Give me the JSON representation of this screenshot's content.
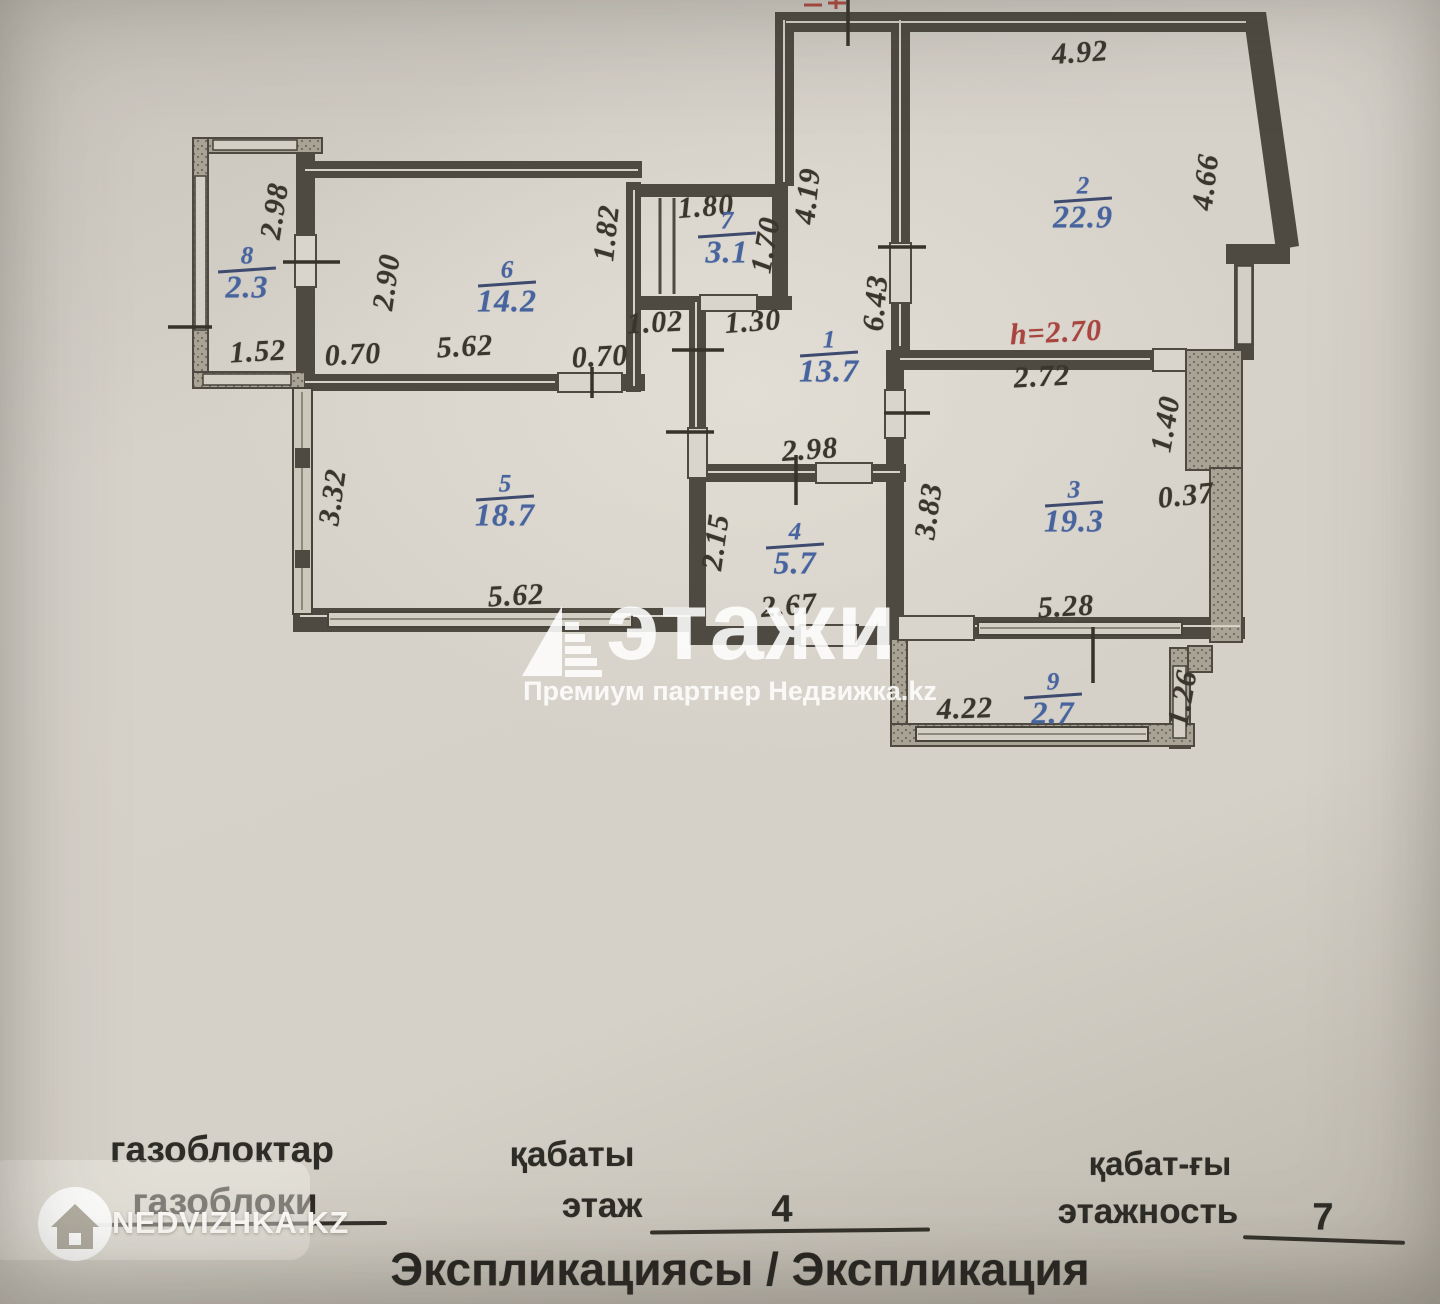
{
  "plan": {
    "rooms": [
      {
        "num": "8",
        "area": "2.3",
        "x": 247,
        "y": 273
      },
      {
        "num": "6",
        "area": "14.2",
        "x": 507,
        "y": 287
      },
      {
        "num": "7",
        "area": "3.1",
        "x": 727,
        "y": 238
      },
      {
        "num": "1",
        "area": "13.7",
        "x": 829,
        "y": 357
      },
      {
        "num": "2",
        "area": "22.9",
        "x": 1083,
        "y": 203
      },
      {
        "num": "5",
        "area": "18.7",
        "x": 505,
        "y": 501
      },
      {
        "num": "4",
        "area": "5.7",
        "x": 795,
        "y": 549
      },
      {
        "num": "3",
        "area": "19.3",
        "x": 1074,
        "y": 507
      },
      {
        "num": "9",
        "area": "2.7",
        "x": 1053,
        "y": 699
      }
    ],
    "dimensions": [
      {
        "t": "4.92",
        "x": 1080,
        "y": 53,
        "r": -4
      },
      {
        "t": "4.66",
        "x": 1206,
        "y": 182,
        "r": -83
      },
      {
        "t": "4.19",
        "x": 808,
        "y": 196,
        "r": -84
      },
      {
        "t": "6.43",
        "x": 876,
        "y": 303,
        "r": -85
      },
      {
        "t": "1.82",
        "x": 607,
        "y": 233,
        "r": -84
      },
      {
        "t": "1.80",
        "x": 706,
        "y": 207,
        "r": -4
      },
      {
        "t": "1.70",
        "x": 766,
        "y": 245,
        "r": -80
      },
      {
        "t": "1.02",
        "x": 655,
        "y": 323,
        "r": -3
      },
      {
        "t": "1.30",
        "x": 753,
        "y": 322,
        "r": -4
      },
      {
        "t": "2.98",
        "x": 275,
        "y": 211,
        "r": -81
      },
      {
        "t": "1.52",
        "x": 258,
        "y": 352,
        "r": -3
      },
      {
        "t": "0.70",
        "x": 353,
        "y": 355,
        "r": -3
      },
      {
        "t": "0.70",
        "x": 600,
        "y": 357,
        "r": -3
      },
      {
        "t": "2.90",
        "x": 387,
        "y": 282,
        "r": -82
      },
      {
        "t": "5.62",
        "x": 465,
        "y": 347,
        "r": -3
      },
      {
        "t": "3.32",
        "x": 333,
        "y": 497,
        "r": -82
      },
      {
        "t": "5.62",
        "x": 516,
        "y": 596,
        "r": -3
      },
      {
        "t": "2.15",
        "x": 716,
        "y": 542,
        "r": -82
      },
      {
        "t": "2.98",
        "x": 810,
        "y": 450,
        "r": -4
      },
      {
        "t": "2.67",
        "x": 789,
        "y": 606,
        "r": -4
      },
      {
        "t": "3.83",
        "x": 929,
        "y": 511,
        "r": -82
      },
      {
        "t": "2.72",
        "x": 1042,
        "y": 377,
        "r": -3
      },
      {
        "t": "1.40",
        "x": 1166,
        "y": 424,
        "r": -80
      },
      {
        "t": "0.37",
        "x": 1186,
        "y": 496,
        "r": -6
      },
      {
        "t": "5.28",
        "x": 1066,
        "y": 607,
        "r": -3
      },
      {
        "t": "4.22",
        "x": 965,
        "y": 709,
        "r": -2
      },
      {
        "t": "1.26",
        "x": 1183,
        "y": 698,
        "r": -80
      },
      {
        "t": "h=2.70",
        "x": 1056,
        "y": 333,
        "r": -3,
        "c": "red"
      }
    ]
  },
  "watermark": {
    "brand": "этажи",
    "subtitle": "Премиум партнер Недвижка.kz"
  },
  "logo": {
    "text": "NEDVIZHKA.KZ"
  },
  "footer": {
    "col1_line1": "газоблоктар",
    "col1_line2": "газоблоки",
    "col2_line1": "қабаты",
    "col2_line2": "этаж",
    "col2_value": "4",
    "col3_line1": "қабат-ғы",
    "col3_line2": "этажность",
    "col3_value": "7",
    "title": "Экспликациясы / Экспликация"
  },
  "colors": {
    "wall": "#4e4a41",
    "room_label_blue": "#47649f",
    "height_note_red": "#a8453e",
    "paper": "#d9d5cc"
  }
}
